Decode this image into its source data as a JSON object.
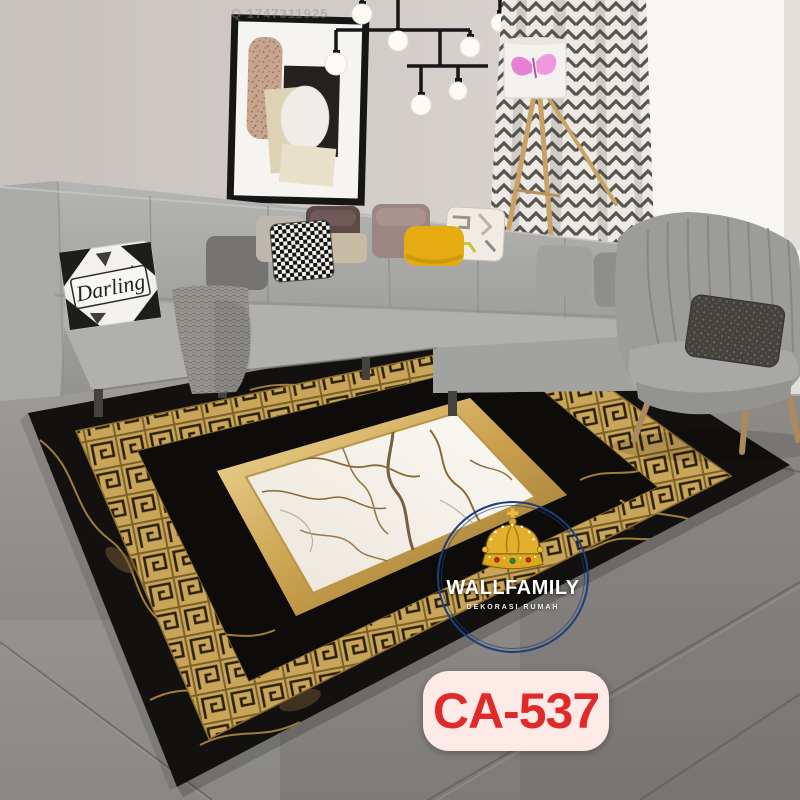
{
  "overlay": {
    "photo_id_watermark": "Q 1747311925",
    "logo": {
      "brand": "WALLFAMILY",
      "tagline": "DEKORASI RUMAH",
      "ring_color": "#1d3e7c",
      "crown_icon": "crown-icon"
    },
    "product_badge": {
      "code": "CA-537",
      "text_color": "#e02a2a",
      "background": "#fdeae7"
    }
  },
  "scene": {
    "description": "Living room with grey sectional sofa, wingback armchair, tripod lamp and a black-gold greek key marble area rug",
    "pillow_text": "Darling",
    "colors": {
      "rug_black": "#121110",
      "rug_gold": "#c9a55a",
      "rug_marble_white": "#f4f0e9",
      "gold_frame": "#caa14e",
      "yellow_pillow": "#e7ab12",
      "butterfly_pink": "#e77fd2",
      "sofa_grey": "#a6a6a4",
      "floor_grey": "#8b8885",
      "wall_grey": "#d0cbc6"
    }
  }
}
